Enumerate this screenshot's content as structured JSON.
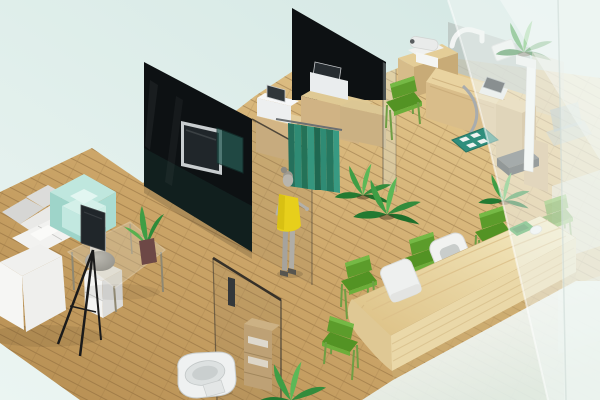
{
  "meta": {
    "description": "3D isometric rendering of a small clinic interior with waiting lounge, curtained consultation room, examination room, toilet cubicle and reception counter",
    "style": "isometric 3D architectural render, no visible text"
  },
  "palette": {
    "bg_teal": "#d3e7e3",
    "bg_teal_light": "#ebf5f2",
    "floor_wood_dark": "#b68e52",
    "floor_wood_mid": "#cda76a",
    "floor_wood_light": "#ecd49b",
    "plank_line": "#7b5a31",
    "wall_black": "#0d1113",
    "glass_tint": "#8e7d60",
    "curtain": "#2f8b74",
    "curtain_dark": "#25705c",
    "person_dress": "#e7cf1b",
    "person_skin": "#b8b5ad",
    "sofa_white": "#f6f6f4",
    "sofa_gray": "#d6d6d4",
    "armchair_mint": "#aadcd2",
    "chair_green": "#5c9c2b",
    "chair_green_seat": "#539324",
    "counter_wood": "#ead8a8",
    "cabinet_wood": "#d3b585",
    "device_white": "#eef0ef",
    "screen_dark": "#20262a",
    "plant_green": "#3f9e45",
    "metal_gray": "#a8acae",
    "toilet_white": "#eff1f1",
    "haze_white": "#f2f8f6",
    "mat_teal": "#2f8e7c"
  },
  "scene": {
    "rooms": [
      {
        "id": "lounge",
        "label": "waiting lounge with sofa, armchair, TV stand and glass coffee table"
      },
      {
        "id": "consult-room",
        "label": "consultation room with black glass partitions, wall TV, device cabinets and privacy curtain"
      },
      {
        "id": "exam-room",
        "label": "examination room with wooden exam desk, instruments and height scale"
      },
      {
        "id": "toilet-cubicle",
        "label": "glass toilet cubicle with toilet and towel shelf"
      },
      {
        "id": "reception",
        "label": "reception area with long wooden counter and green chairs"
      }
    ],
    "objects": [
      {
        "id": "l-sofa",
        "label": "white L-shaped sectional sofa"
      },
      {
        "id": "mint-armchair",
        "label": "mint green armchair"
      },
      {
        "id": "tv-tripod",
        "label": "flat TV on black tripod stand"
      },
      {
        "id": "coffee-table",
        "label": "glass coffee table with plant vase"
      },
      {
        "id": "side-cabinet",
        "label": "white drawer unit with gray bowl"
      },
      {
        "id": "wall-tv",
        "label": "TV mounted on black glass partition"
      },
      {
        "id": "privacy-curtain",
        "label": "teal privacy curtain on rail"
      },
      {
        "id": "person",
        "label": "standing woman in yellow dress"
      },
      {
        "id": "device-cabinets",
        "label": "two wooden cabinets with white medical devices"
      },
      {
        "id": "exam-desk",
        "label": "wooden exam desk with tablet, scope and instrument arm"
      },
      {
        "id": "stadiometer",
        "label": "white height measuring scale with platform"
      },
      {
        "id": "floor-mat",
        "label": "teal floor mat with white pads"
      },
      {
        "id": "toilet",
        "label": "white toilet"
      },
      {
        "id": "towel-shelf",
        "label": "wooden towel shelf"
      },
      {
        "id": "reception-counter",
        "label": "long light-wood reception counter"
      },
      {
        "id": "reception-monitor",
        "label": "white monitor on counter"
      },
      {
        "id": "office-chair",
        "label": "white office chair"
      },
      {
        "id": "green-chairs",
        "label": "six green visitor chairs",
        "count": 6
      },
      {
        "id": "plants",
        "label": "green potted plants",
        "count": 5
      },
      {
        "id": "frosted-wall",
        "label": "frosted glass wall on the right"
      }
    ]
  }
}
